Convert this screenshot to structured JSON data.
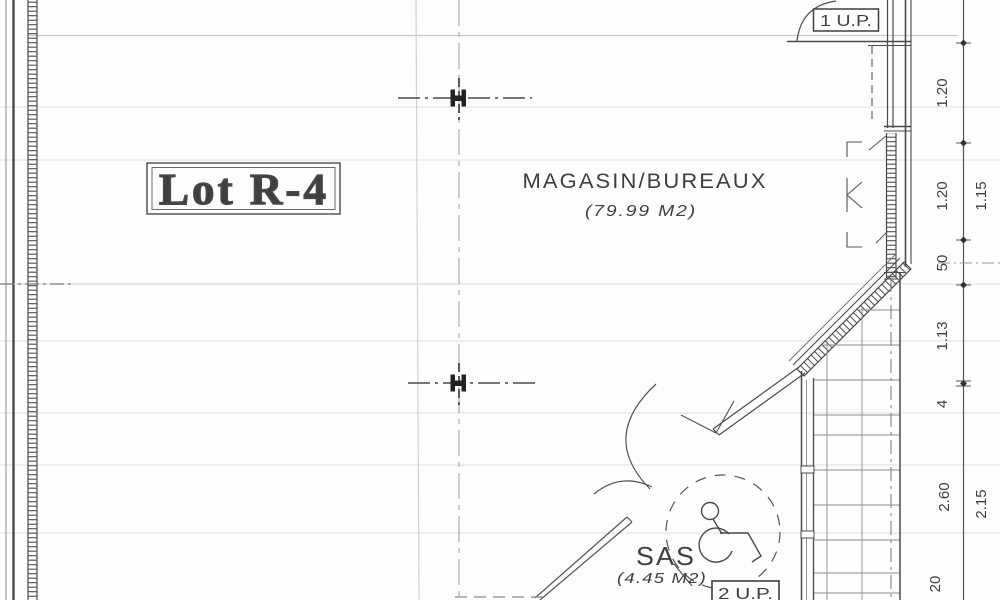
{
  "plan": {
    "lot_label": "Lot R-4",
    "rooms": [
      {
        "name": "MAGASIN/BUREAUX",
        "area": "(79.99 M2)"
      },
      {
        "name": "SAS",
        "area": "(4.45 M2)"
      }
    ],
    "doors": {
      "up1": "1 U.P.",
      "up2": "2 U.P."
    },
    "dimensions": {
      "chain_inner": [
        "1.20",
        "1.20",
        "50",
        "1.13",
        "4",
        "2.60",
        "20"
      ],
      "chain_outer": [
        "1.15",
        "2.15"
      ]
    },
    "icons": {
      "wheelchair": "wheelchair-accessibility-symbol",
      "column": "steel-H-column"
    },
    "colors": {
      "line": "#4a4a4a",
      "text": "#3f3f3f",
      "paper": "#fdfdfc"
    }
  }
}
